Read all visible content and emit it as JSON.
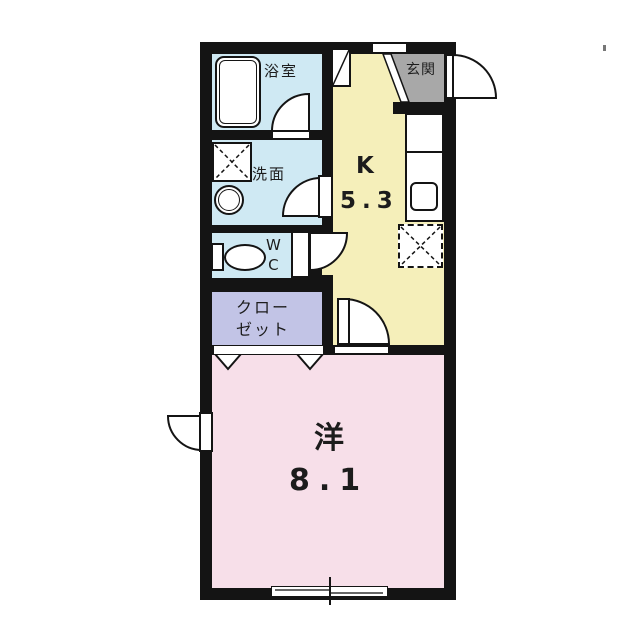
{
  "floorplan": {
    "labels": {
      "bathroom": "浴室",
      "washroom": "洗面",
      "wc": "W\nC",
      "closet": "クロー\nゼット",
      "entrance": "玄関",
      "kitchen_letter": "K",
      "kitchen_size": "5.3",
      "western_room_letter": "洋",
      "western_room_size": "8.1"
    },
    "colors": {
      "wet_area_blue": "#cfe9f3",
      "kitchen_yellow": "#f5efba",
      "entrance_gray": "#a8a8a8",
      "closet_lavender": "#c2c4e6",
      "room_pink": "#f7dfe9",
      "wall_black": "#141414"
    },
    "fixtures": [
      "bathtub",
      "washing-machine-pan",
      "wash-basin",
      "toilet",
      "shoe-cabinet",
      "kitchen-counter",
      "kitchen-sink",
      "refrigerator-space",
      "entrance-step",
      "folding-closet-doors",
      "sliding-window",
      "swing-doors"
    ]
  }
}
